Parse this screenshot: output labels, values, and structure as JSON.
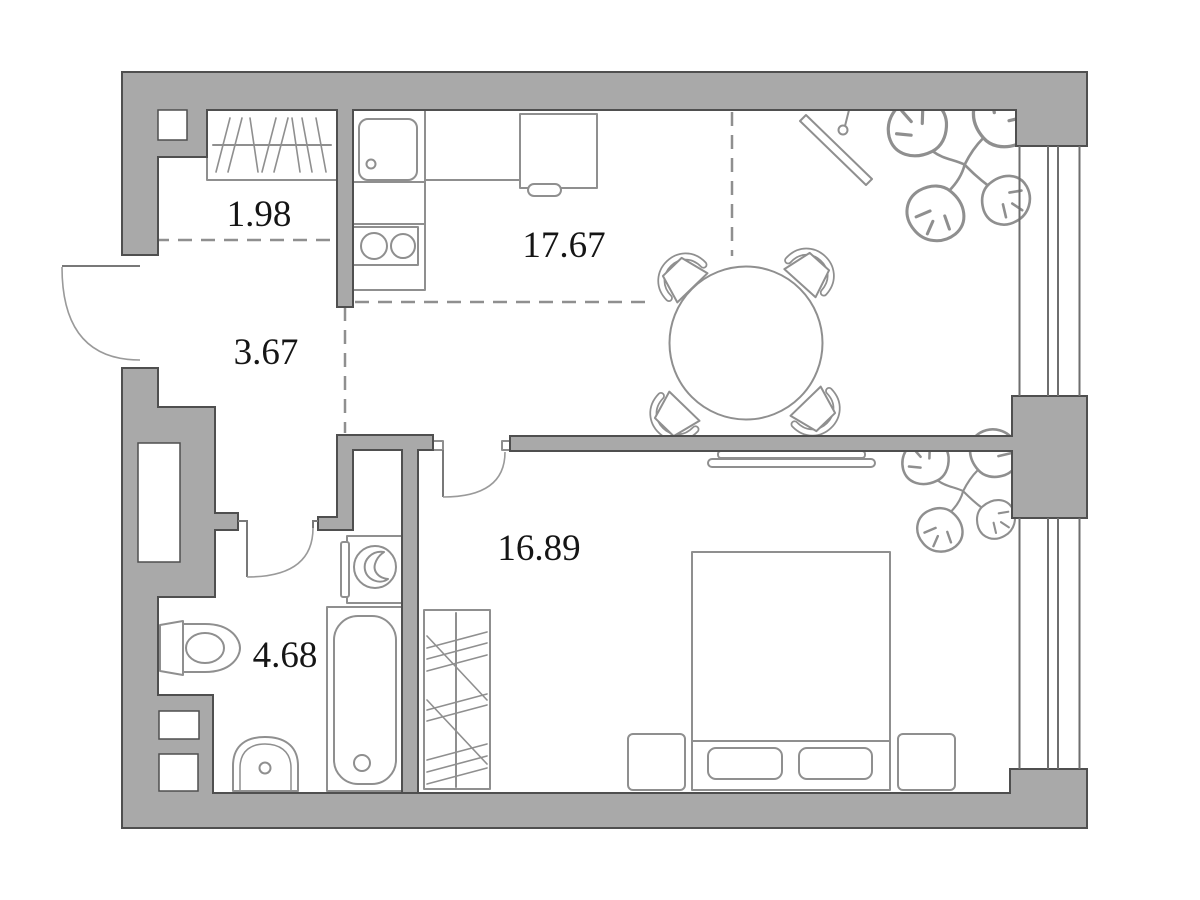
{
  "plan": {
    "type": "apartment floor plan",
    "units": "m2"
  },
  "colors": {
    "wall_fill": "#a9a9a9",
    "wall_outline": "#4f4f4f",
    "fixture_line": "#8f8f8f",
    "zone_dash": "#8f8f8f",
    "window_line": "#6e6e6e",
    "label_text": "#151515",
    "floor": "#ffffff"
  },
  "rooms": [
    {
      "id": "entry-closet",
      "label": "1.98"
    },
    {
      "id": "hallway",
      "label": "3.67"
    },
    {
      "id": "kitchen-living",
      "label": "17.67"
    },
    {
      "id": "bedroom",
      "label": "16.89"
    },
    {
      "id": "bathroom",
      "label": "4.68"
    }
  ],
  "furniture": [
    "entry-closet-hangers",
    "kitchen-sink",
    "kitchen-counter",
    "stove",
    "refrigerator",
    "dining-table",
    "dining-chairs",
    "wall-tv-living",
    "monstera-plant-living",
    "bed",
    "pillows",
    "nightstands",
    "bedroom-wardrobe",
    "bedroom-wall-tv",
    "monstera-plant-bedroom",
    "bathtub",
    "washing-machine",
    "toilet",
    "washbasin"
  ],
  "openings": [
    "entry-door",
    "bathroom-door",
    "bedroom-door",
    "window-living",
    "window-bedroom"
  ]
}
